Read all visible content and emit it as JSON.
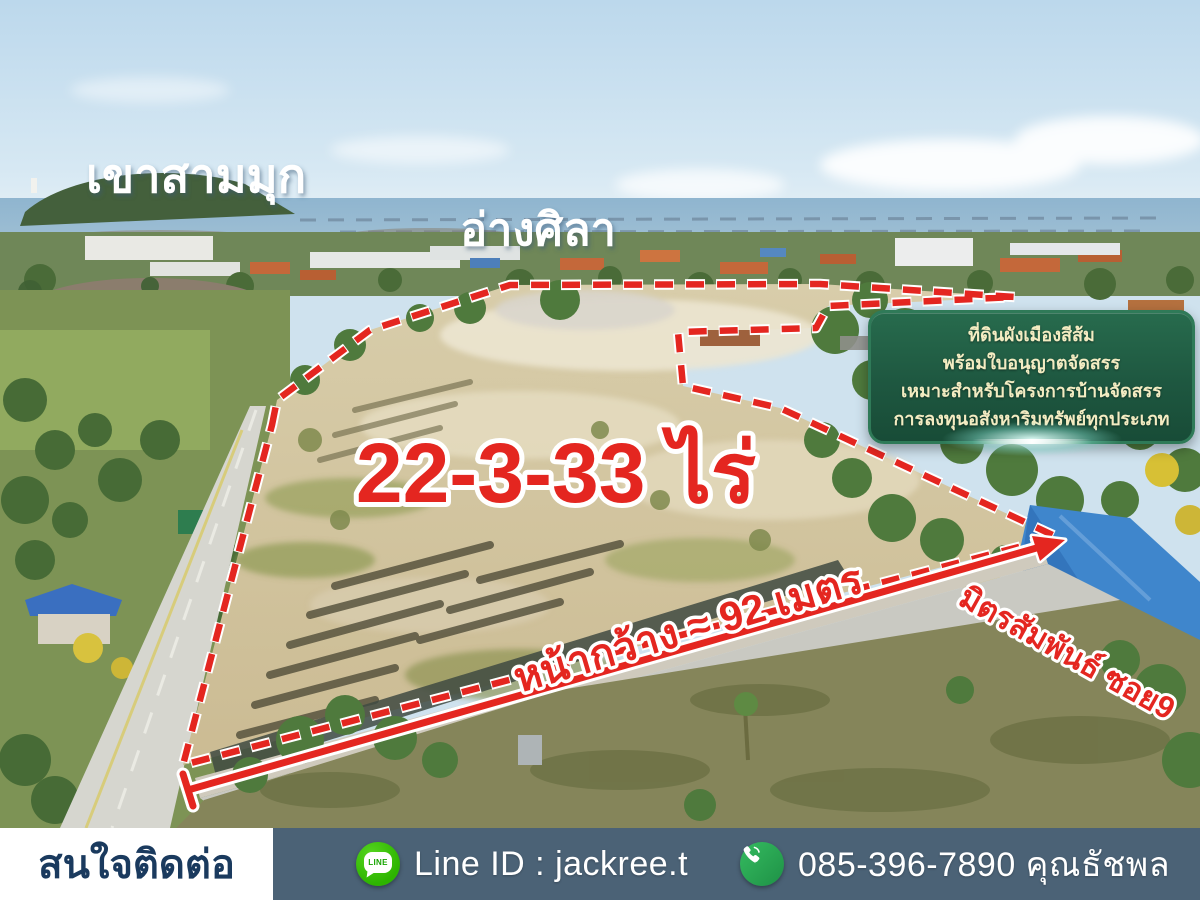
{
  "overlay_labels": {
    "mountain": "เขาสามมุก",
    "bay_town": "อ่างศิลา",
    "area": "22-3-33 ไร่",
    "frontage": "หน้ากว้าง ≈ 92 เมตร",
    "road": "มิตรสัมพันธ์ ซอย9"
  },
  "info_box": {
    "lines": [
      "ที่ดินผังเมืองสีส้ม",
      "พร้อมใบอนุญาตจัดสรร",
      "เหมาะสำหรับโครงการบ้านจัดสรร",
      "การลงทุนอสังหาริมทรัพย์ทุกประเภท"
    ]
  },
  "contact_bar": {
    "heading": "สนใจติดต่อ",
    "line_id": "Line ID : jackree.t",
    "line_icon_text": "LINE",
    "phone": "085-396-7890 คุณธัชพล",
    "icons": {
      "line": "line-app-icon",
      "phone": "phone-call-icon"
    }
  },
  "colors": {
    "accent_red": "#e42620",
    "outline_white": "#ffffff",
    "info_box_green": "#1e5740",
    "info_text_cream": "#f3ecc2",
    "bar_slate": "#4b6276",
    "bar_navy": "#1a3a5e",
    "line_green": "#2db400",
    "phone_green": "#28a756"
  }
}
